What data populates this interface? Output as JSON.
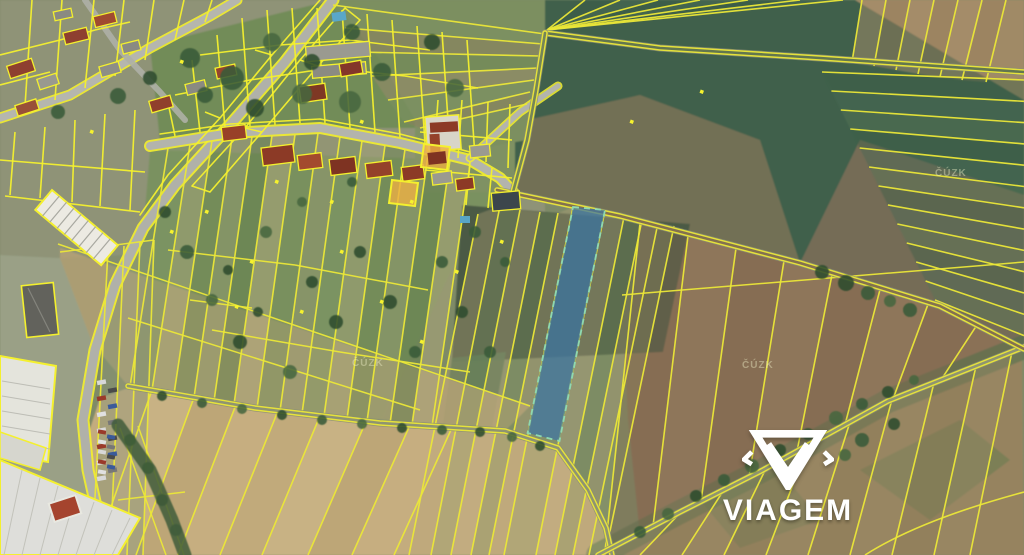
{
  "branding": {
    "logo_text": "VIAGEM"
  },
  "map": {
    "watermarks": [
      {
        "text": "ČÚZK"
      },
      {
        "text": "ČÚZK"
      },
      {
        "text": "ČÚZK"
      }
    ],
    "colors": {
      "parcel_line": "#ebe738",
      "parcel_line_bright": "#f4f02e",
      "selected_parcel_fill": "#3d74a3",
      "selected_parcel_border": "#8fd9b0",
      "logo_color": "#ffffff"
    }
  }
}
